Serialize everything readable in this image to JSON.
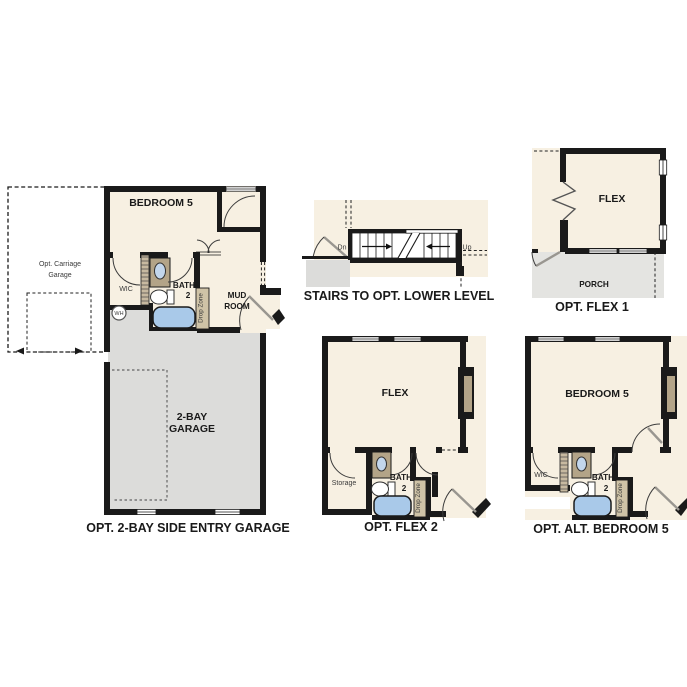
{
  "colors": {
    "background": "#ffffff",
    "wall": "#1a1a1a",
    "room_fill": "#f7f0e2",
    "garage_fill": "#dcdcda",
    "porch_fill": "#e4e4e1",
    "tub_blue": "#a9c9e9",
    "sink_blue": "#c2d6ec",
    "vanity_tan": "#b3a488",
    "dropzone_tan": "#cfc3a7",
    "hatch_tan": "#c7b9a0",
    "door_gray": "#999690",
    "label_dark": "#1a1a1a",
    "label_gray": "#3a3a3a"
  },
  "icons": {
    "door_swing": "quarter-arc",
    "door_leaf": "diagonal-line",
    "window": "double-line-gap",
    "bathtub": "rounded-rect",
    "sink": "oval",
    "toilet": "bowl-and-tank",
    "water_heater": "circle",
    "stairs": "tread-lines-with-break",
    "fireplace": "wall-bump"
  },
  "panels": {
    "garage_plan": {
      "caption": "OPT. 2-BAY SIDE ENTRY GARAGE",
      "rooms": {
        "bedroom": "BEDROOM 5",
        "garage_line1": "2-BAY",
        "garage_line2": "GARAGE",
        "carriage_line1": "Opt. Carriage",
        "carriage_line2": "Garage",
        "wic": "WIC",
        "bath_line1": "BATH",
        "bath_line2": "2",
        "mud_line1": "MUD",
        "mud_line2": "ROOM",
        "drop_zone": "Drop Zone",
        "water_heater": "WH"
      }
    },
    "stairs_plan": {
      "caption": "STAIRS TO OPT. LOWER LEVEL",
      "labels": {
        "down": "Dn",
        "up": "Up"
      }
    },
    "flex1_plan": {
      "caption": "OPT. FLEX 1",
      "rooms": {
        "flex": "FLEX",
        "porch": "PORCH"
      }
    },
    "flex2_plan": {
      "caption": "OPT. FLEX 2",
      "rooms": {
        "flex": "FLEX",
        "storage": "Storage",
        "bath_line1": "BATH",
        "bath_line2": "2",
        "drop_zone": "Drop Zone"
      }
    },
    "alt_bedroom5_plan": {
      "caption": "OPT. ALT. BEDROOM 5",
      "rooms": {
        "bedroom": "BEDROOM 5",
        "wic": "WIC",
        "bath_line1": "BATH",
        "bath_line2": "2",
        "drop_zone": "Drop Zone"
      }
    }
  }
}
